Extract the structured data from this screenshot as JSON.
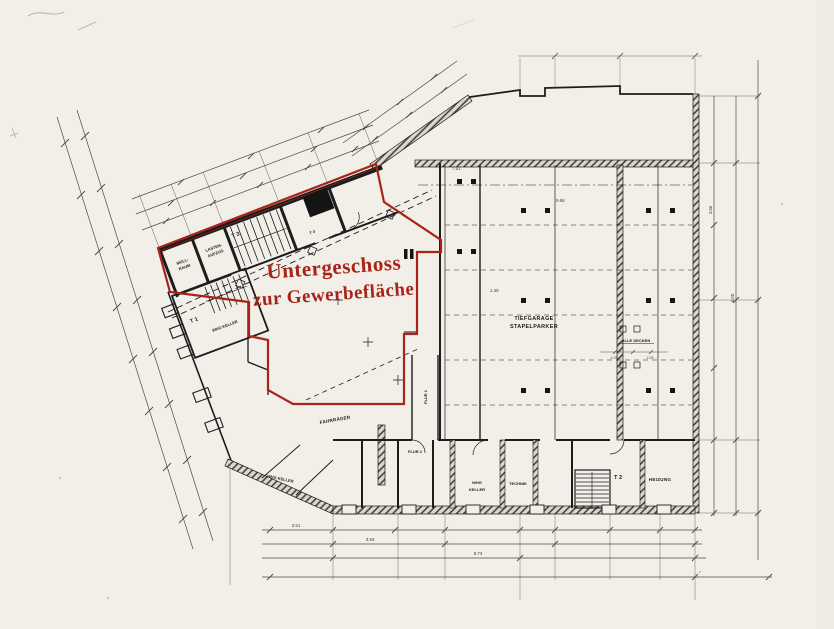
{
  "title": {
    "line1": "Untergeschoss",
    "line2": "zur Gewerbefläche"
  },
  "colors": {
    "highlight": "#a8241a",
    "paper": "#f2efe8",
    "ink": "#1d1d1d"
  },
  "rooms": {
    "muellraum_l1": "MÜLL-",
    "muellraum_l2": "RAUM",
    "aufzug_l1": "LASTEN-",
    "aufzug_l2": "AUFZUG",
    "stair3": "T 3",
    "stair1": "T 1",
    "stair2": "T 2",
    "door4": "T 4",
    "whg_keller_a": "WHG KELLER",
    "whg_keller_b": "WHG KELLER",
    "whg_keller_c_l1": "WHG",
    "whg_keller_c_l2": "KELLER",
    "fahrraeder": "FAHRRÄDER",
    "flur1": "FLUR 1",
    "flur2": "FLUR 2",
    "technik": "TECHNIK",
    "heizung": "HEIZUNG",
    "garage_l1": "TIEFGARAGE",
    "garage_l2": "STAPELPARKER"
  },
  "annotations": {
    "decken": "ALLE DECKEN",
    "h1": "2.25",
    "h2": "2.25"
  },
  "dims": {
    "d1": "7.51",
    "d2": "9.68",
    "d3": "1.35",
    "d4": "2.51",
    "d5": "3.93",
    "d6": "8.73",
    "d7": "5.00",
    "d8": "3.86"
  }
}
